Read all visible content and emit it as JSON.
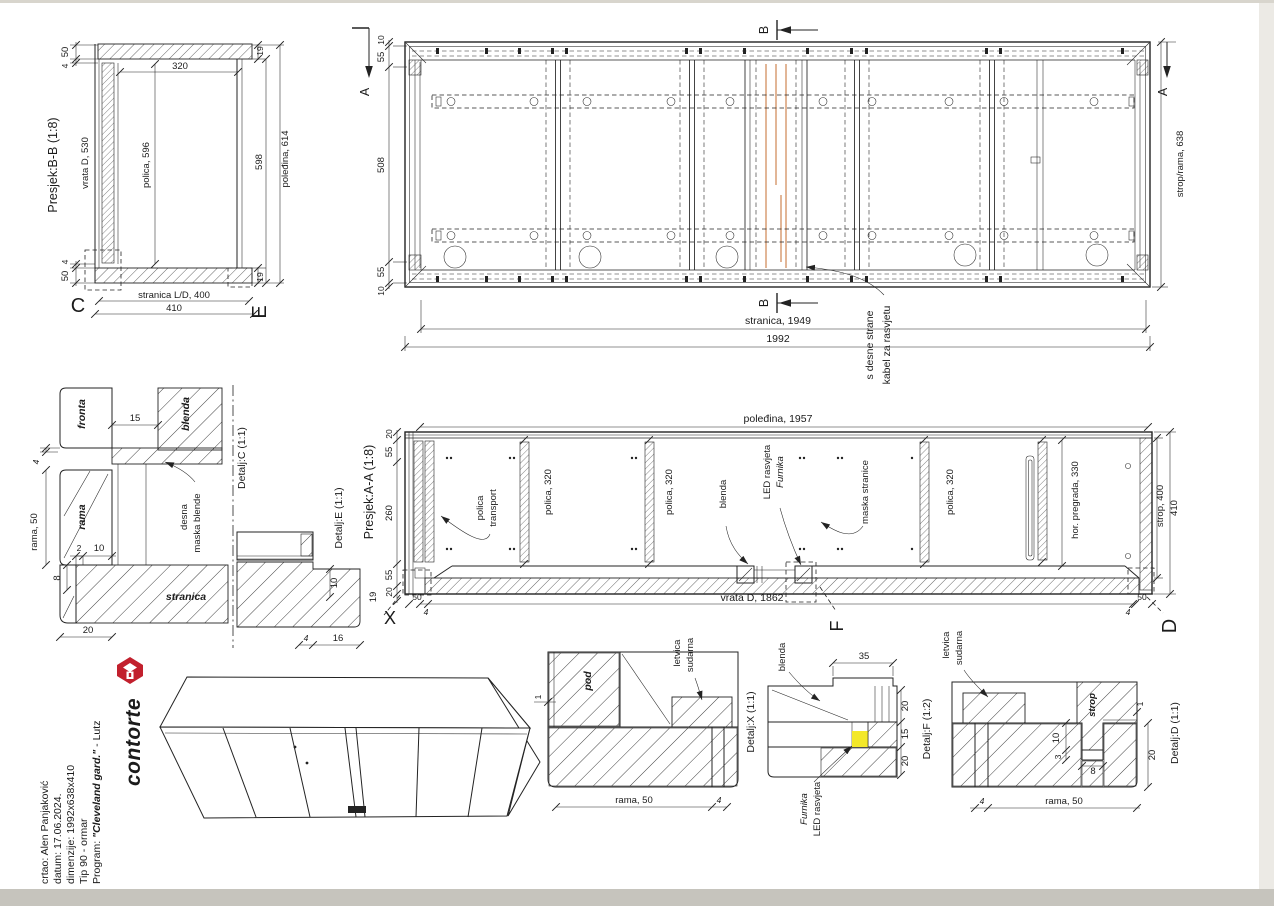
{
  "bb": {
    "title": "Presjek:B-B (1:8)",
    "dim_50": "50",
    "dim_4": "4",
    "dim_320": "320",
    "dim_19": "19",
    "vrata": "vrata D, 530",
    "polica": "polica, 596",
    "dim_598": "598",
    "poledina": "poleđina, 614",
    "stranica": "stranica L/D, 400",
    "dim_410": "410",
    "marker_c": "C",
    "marker_e": "E"
  },
  "plan": {
    "dim_10": "10",
    "dim_55": "55",
    "dim_508": "508",
    "marker_a": "A",
    "marker_b": "B",
    "strop_rama": "strop/rama, 638",
    "stranica": "stranica, 1949",
    "total": "1992",
    "kabel_1": "kabel za rasvjetu",
    "kabel_2": "s desne strane"
  },
  "aa": {
    "title": "Presjek:A-A (1:8)",
    "poledina": "poleđina, 1957",
    "dim_20": "20",
    "dim_55": "55",
    "dim_260": "260",
    "dim_19": "19",
    "transport_1": "transport",
    "transport_2": "polica",
    "polica_320": "polica, 320",
    "blenda": "blenda",
    "led": "LED rasvjeta",
    "furnika": "Furnika",
    "maska": "maska stranice",
    "pregrada": "hor. pregrada, 330",
    "strop": "strop, 400",
    "dim_410": "410",
    "vrata": "vrata D, 1862",
    "dim_50": "50",
    "dim_4": "4",
    "marker_x": "X",
    "marker_f": "F",
    "marker_d": "D"
  },
  "dc": {
    "title": "Detalj:C (1:1)",
    "fronta": "fronta",
    "blenda": "blenda",
    "rama": "rama",
    "stranica": "stranica",
    "maska_1": "maska blende",
    "maska_2": "desna",
    "rama_50": "rama, 50",
    "dim_15": "15",
    "dim_4": "4",
    "dim_2": "2",
    "dim_10": "10",
    "dim_8": "8",
    "dim_20": "20"
  },
  "de": {
    "title": "Detalj:E (1:1)",
    "dim_10": "10",
    "dim_4": "4",
    "dim_16": "16"
  },
  "dx": {
    "title": "Detalj:X (1:1)",
    "pod": "pod",
    "sudarna": "sudarna",
    "letvica": "letvica",
    "dim_1": "1",
    "rama_50": "rama, 50",
    "dim_4": "4"
  },
  "df": {
    "title": "Detalj:F (1:2)",
    "blenda": "blenda",
    "led": "LED rasvjeta",
    "furnika": "Furnika",
    "dim_35": "35",
    "dim_20": "20",
    "dim_15": "15"
  },
  "dd": {
    "title": "Detalj:D (1:1)",
    "sudarna": "sudarna",
    "letvica": "letvica",
    "strop": "strop",
    "dim_1": "1",
    "dim_20": "20",
    "dim_10": "10",
    "dim_3": "3",
    "dim_8": "8",
    "dim_4": "4",
    "rama_50": "rama, 50"
  },
  "footer": {
    "logo": "contorte",
    "program_label": "Program: ",
    "program_name": "\"Cleveland gard.\"",
    "program_suffix": " - Lutz",
    "tip": "Tip 90 - ormar",
    "dimenzije": "dimenzije: 1992x638x410",
    "datum": "datum: 17.06.2024.",
    "crtao": "crtao: Alen Panjaković"
  },
  "colors": {
    "cable": "#dba47d",
    "led": "#f3e829",
    "logo_red": "#c2202d"
  }
}
